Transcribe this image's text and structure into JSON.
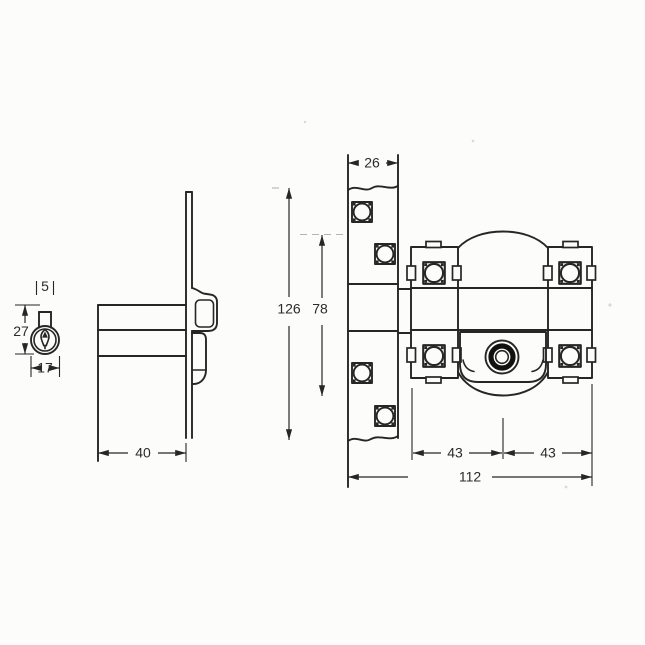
{
  "document": {
    "type": "engineering-diagram",
    "subject": "Rim lock (night latch) technical drawing: cylinder profile, side view and front view with millimetre dimensions"
  },
  "side_view": {
    "cylinder": {
      "stem_width": "5",
      "height": "27",
      "width": "17"
    },
    "case_depth": "40"
  },
  "front_view": {
    "plate_width": "26",
    "overall_height": "126",
    "fixing_span": "78",
    "center_to_left": "43",
    "center_to_right": "43",
    "overall_width": "112"
  },
  "colors": {
    "line": "#262626",
    "background": "#fcfcfa"
  }
}
